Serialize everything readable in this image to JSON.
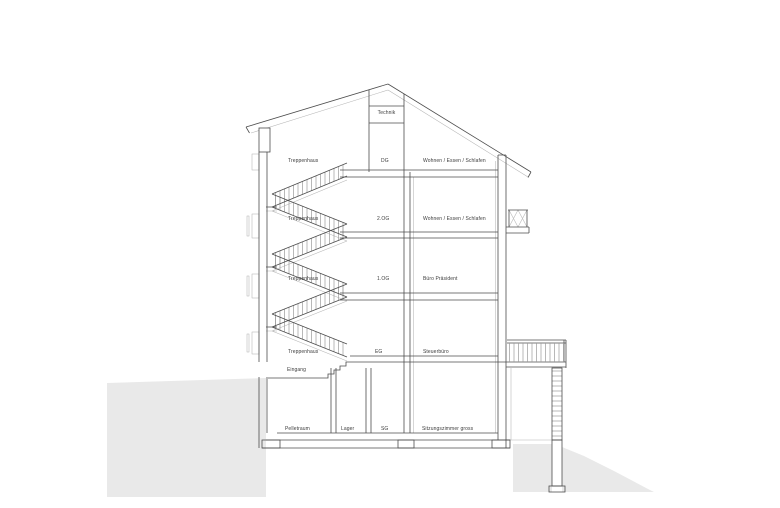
{
  "drawing": {
    "type": "architectural-section",
    "colors": {
      "background": "#ffffff",
      "line_dark": "#4d4d4d",
      "line_light": "#b5b5b5",
      "terrain_fill": "#e9e9e9",
      "text": "#3d3d3d"
    },
    "attic_room": "Technik",
    "levels": [
      {
        "code": "DG",
        "stair_zone": "Treppenhaus",
        "room": "Wohnen / Essen / Schlafen"
      },
      {
        "code": "2.OG",
        "stair_zone": "Treppenhaus",
        "room": "Wohnen / Essen / Schlafen"
      },
      {
        "code": "1.OG",
        "stair_zone": "Treppenhaus",
        "room": "Büro Präsident"
      },
      {
        "code": "EG",
        "stair_zone": "Treppenhaus",
        "room": "Steuerbüro"
      }
    ],
    "entrance_label": "Eingang",
    "basement": {
      "code": "SG",
      "room_left": "Pelletraum",
      "room_mid": "Lager",
      "room_right": "Sitzungszimmer gross"
    }
  }
}
